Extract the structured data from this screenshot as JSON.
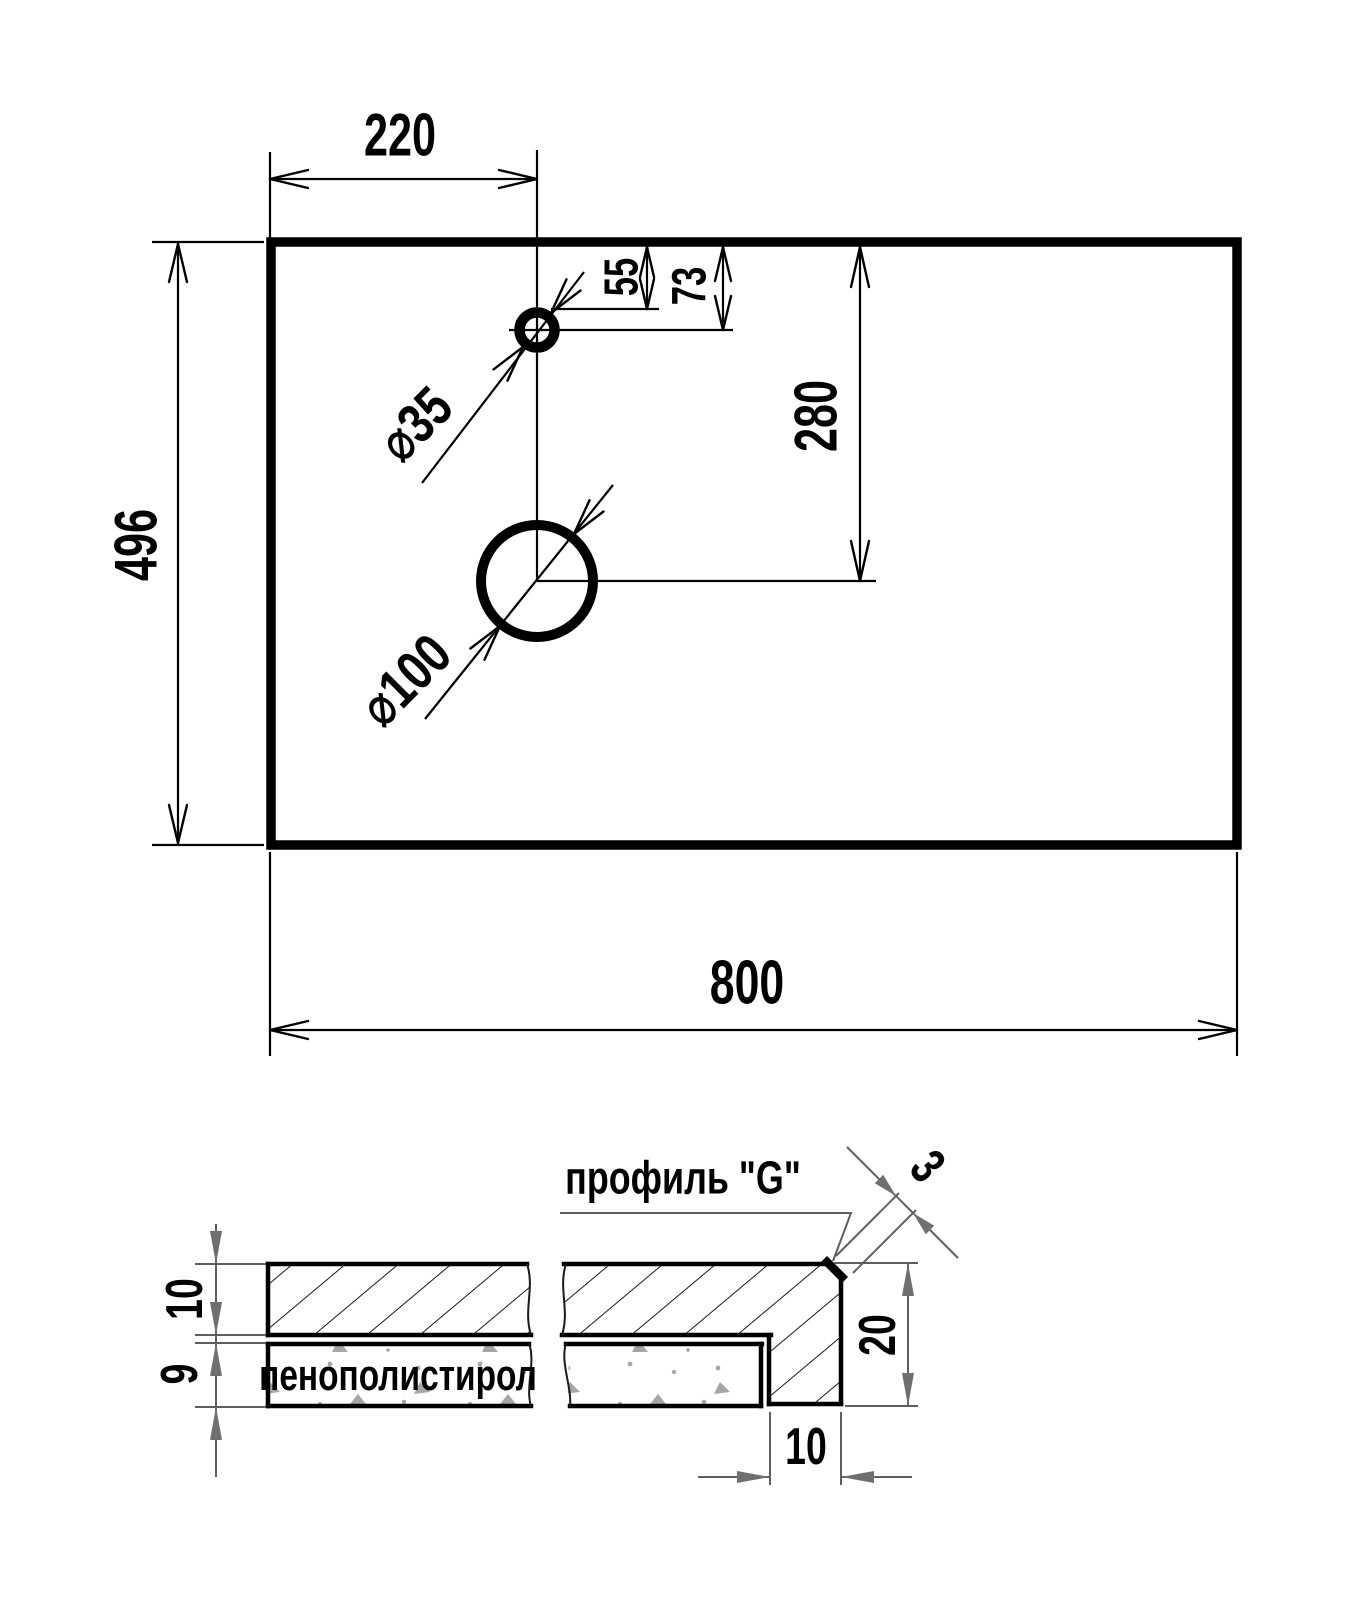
{
  "plan": {
    "panel_width": "800",
    "panel_height": "496",
    "faucet_hole_offset_x": "220",
    "edge_to_faucet_hole_top": "55",
    "edge_to_faucet_hole_center": "73",
    "edge_to_drain_hole_center": "280",
    "faucet_hole_diameter": "⌀35",
    "drain_hole_diameter": "⌀100"
  },
  "section": {
    "title": "профиль \"G\"",
    "top_board_thickness": "10",
    "foam_thickness": "9",
    "profile_height": "20",
    "profile_width": "10",
    "profile_wall_thickness": "3",
    "foam_material_label": "пенополистирол"
  },
  "colors": {
    "background": "#ffffff",
    "drawing_line": "#000000",
    "section_dim_line": "#5f5f5f",
    "section_dim_arrow": "#6f6f6f",
    "foam_stipple": "#a6a6a6"
  }
}
